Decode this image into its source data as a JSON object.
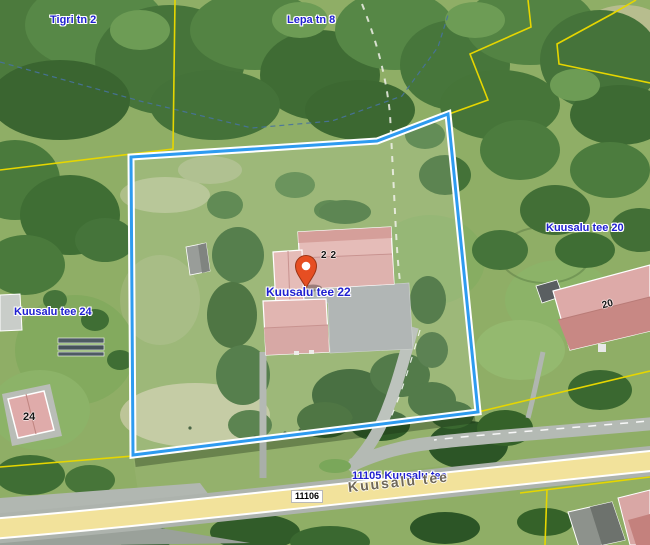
{
  "map": {
    "address_labels": {
      "tigri": "Tigri tn 2",
      "lepa": "Lepa tn 8",
      "kuusalu20": "Kuusalu tee 20",
      "kuusalu24": "Kuusalu tee 24",
      "marker": "Kuusalu tee 22"
    },
    "building_numbers": {
      "b22": "22",
      "b20": "20",
      "b24": "24"
    },
    "road": {
      "ref_label": "11105 Kuusalu tee",
      "name": "Kuusalu tee",
      "number_badge": "11106"
    },
    "colors": {
      "parcel_boundary": "#2e9bf0",
      "cadastral_line": "#e6d600",
      "marker_fill": "#e64e22",
      "road_fill": "#f2e29b",
      "address_text": "#1f1fd0"
    }
  }
}
